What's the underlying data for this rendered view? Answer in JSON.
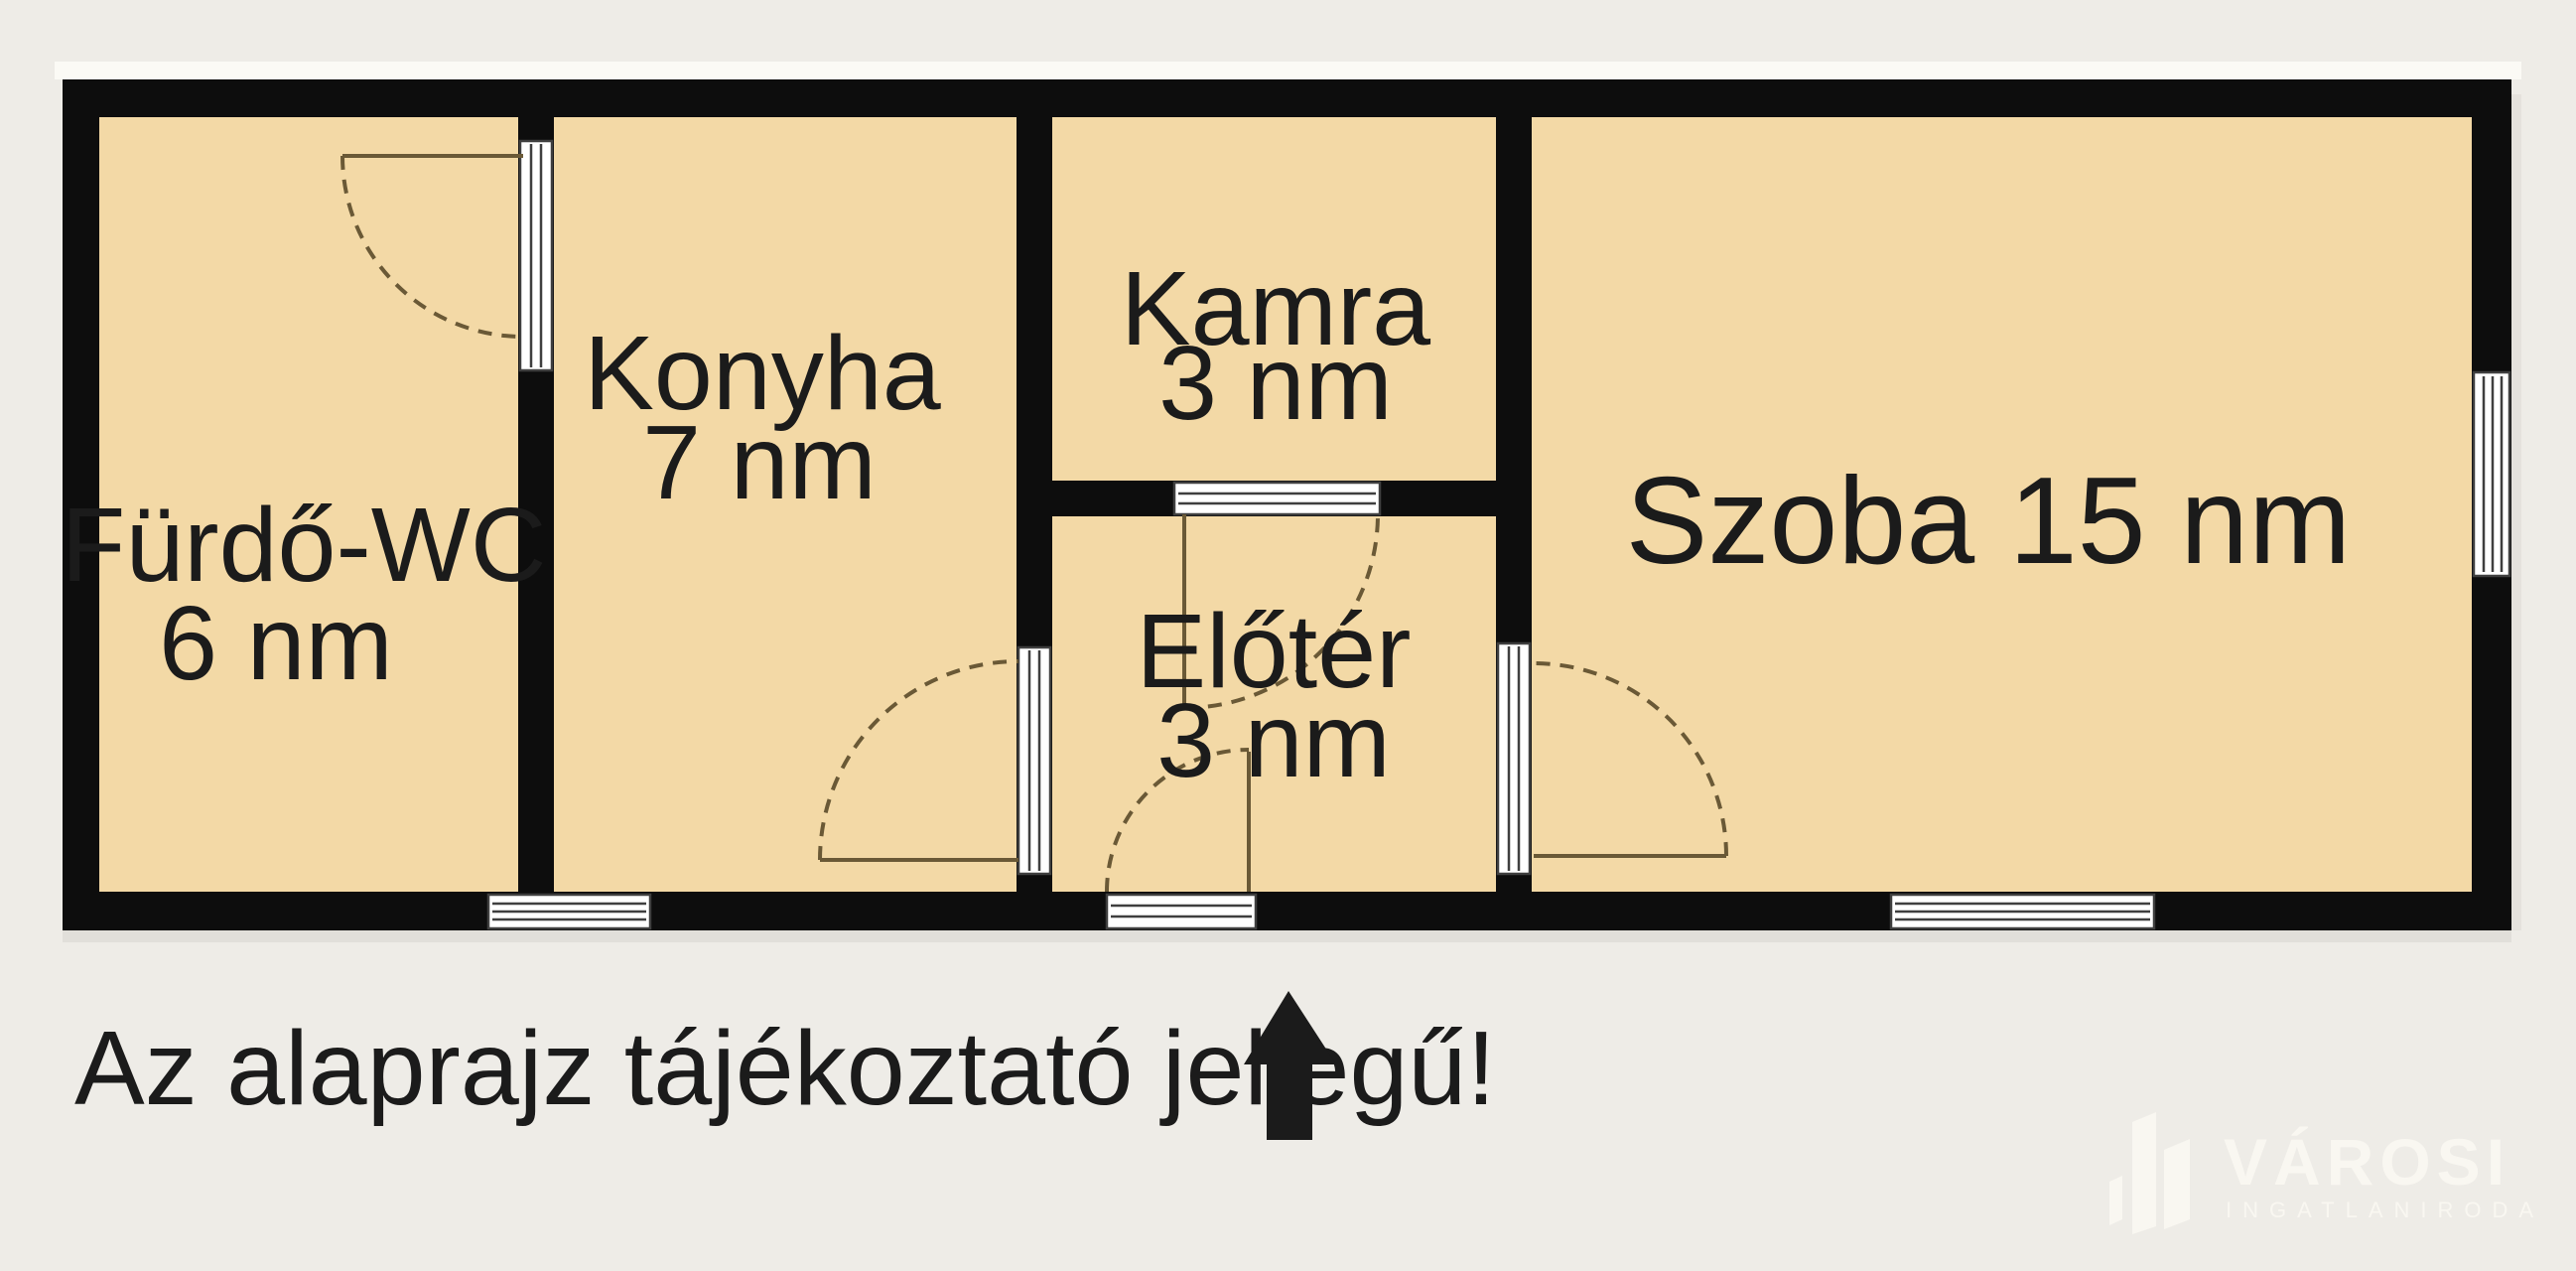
{
  "colors": {
    "background": "#eeece7",
    "room_fill": "#f3d9a6",
    "wall": "#0d0d0d",
    "line": "#6a5936",
    "symbol_stroke": "#3f3f3f",
    "symbol_fill": "#ffffff",
    "text": "#1b1b1b",
    "logo": "#f9f7f1",
    "highlight": "#fbfaf5"
  },
  "rooms": {
    "furdo_wc": {
      "label": "Fürdő-WC",
      "area": "6 nm"
    },
    "konyha": {
      "label": "Konyha",
      "area": "7 nm"
    },
    "kamra": {
      "label": "Kamra",
      "area": "3 nm"
    },
    "eloter": {
      "label": "Előtér",
      "area": "3 nm"
    },
    "szoba": {
      "label": "Szoba 15 nm"
    }
  },
  "caption": "Az alaprajz tájékoztató jellegű!",
  "logo": {
    "brand": "VÁROSI",
    "subtitle": "INGATLANIRODA"
  }
}
